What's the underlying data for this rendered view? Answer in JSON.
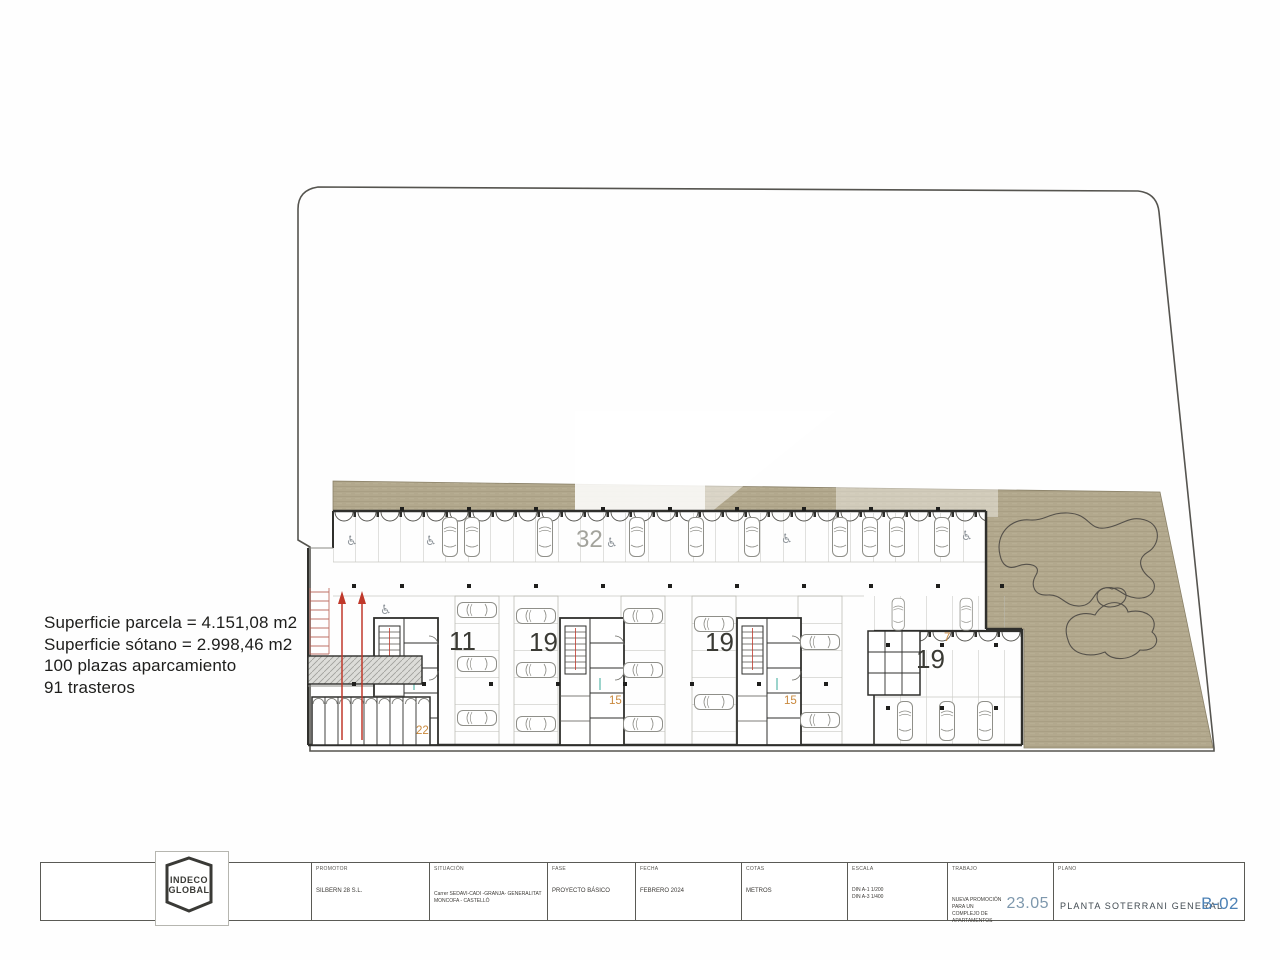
{
  "summary": {
    "lines": [
      "Superficie parcela = 4.151,08 m2",
      "Superficie sótano = 2.998,46 m2",
      "100 plazas aparcamiento",
      "91 trasteros"
    ]
  },
  "plan": {
    "labels": {
      "top_row_count": "32",
      "zone1": "11",
      "zone2": "19",
      "zone3": "19",
      "zone4": "19",
      "orange_ramp": "22",
      "orange_mid1": "15",
      "orange_mid2": "15",
      "orange_right": "7"
    },
    "icons": {
      "accessible": "♿"
    },
    "colors": {
      "ground": "#b2a88d",
      "wall": "#2f2f2c",
      "ramp_red": "#c0392b",
      "accent_orange": "#c9893d"
    }
  },
  "titleblock": {
    "logo": {
      "line1": "INDECO",
      "line2": "GLOBAL"
    },
    "fields": [
      {
        "label": "PROMOTOR",
        "value": "SILBERN 28 S.L."
      },
      {
        "label": "SITUACIÓN",
        "value": "Carrer SEDAVI-CADI -GRANJA- GENERALITAT\nMONCOFA - CASTELLÓ"
      },
      {
        "label": "FASE",
        "value": "PROYECTO BÁSICO"
      },
      {
        "label": "FECHA",
        "value": "FEBRERO 2024"
      },
      {
        "label": "COTAS",
        "value": "METROS"
      },
      {
        "label": "ESCALA",
        "value": "DIN A-1      1/200\nDIN A-3      1/400"
      }
    ],
    "trabajo": {
      "label": "TRABAJO",
      "value": "NUEVA PROMOCIÓN PARA UN\nCOMPLEJO DE APARTAMENTOS",
      "code": "23.05"
    },
    "plano": {
      "label": "PLANO",
      "value": "PLANTA SOTERRANI GENERAL",
      "sheet": "B-02"
    }
  }
}
